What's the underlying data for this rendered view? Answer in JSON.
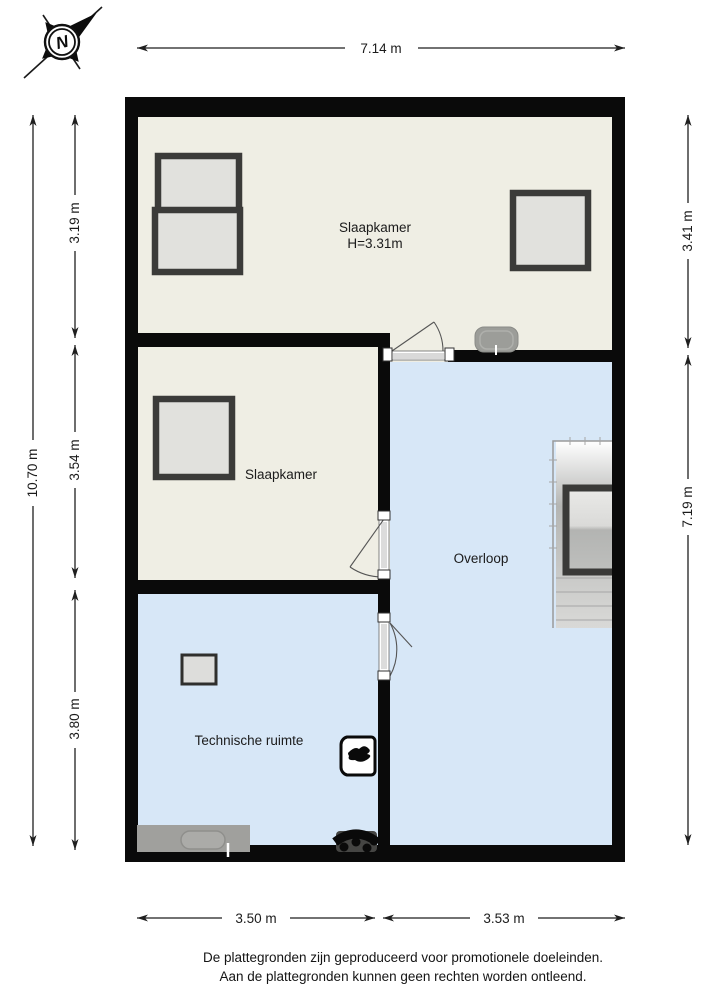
{
  "compass": {
    "label": "N"
  },
  "plan": {
    "rooms": {
      "slaapkamer1": {
        "label": "Slaapkamer",
        "height": "H=3.31m"
      },
      "slaapkamer2": {
        "label": "Slaapkamer"
      },
      "overloop": {
        "label": "Overloop"
      },
      "technische_ruimte": {
        "label": "Technische ruimte"
      }
    },
    "dimensions": {
      "top_width": "7.14 m",
      "left_total": "10.70 m",
      "left_top": "3.19 m",
      "left_middle": "3.54 m",
      "left_bottom": "3.80 m",
      "right_top": "3.41 m",
      "right_bottom": "7.19 m",
      "bottom_left": "3.50 m",
      "bottom_right": "3.53 m"
    },
    "colors": {
      "wall": "#0a0a0a",
      "floor_cream": "#efeee4",
      "floor_blue": "#d7e7f7",
      "window_frame": "#3b3b39",
      "window_fill": "#e1e1dd",
      "fixture_gray": "#9e9e9b",
      "dimension_line": "#1f1f1f"
    }
  },
  "footer": {
    "line1": "De plattegronden zijn geproduceerd voor promotionele doeleinden.",
    "line2": "Aan de plattegronden kunnen geen rechten worden ontleend."
  }
}
